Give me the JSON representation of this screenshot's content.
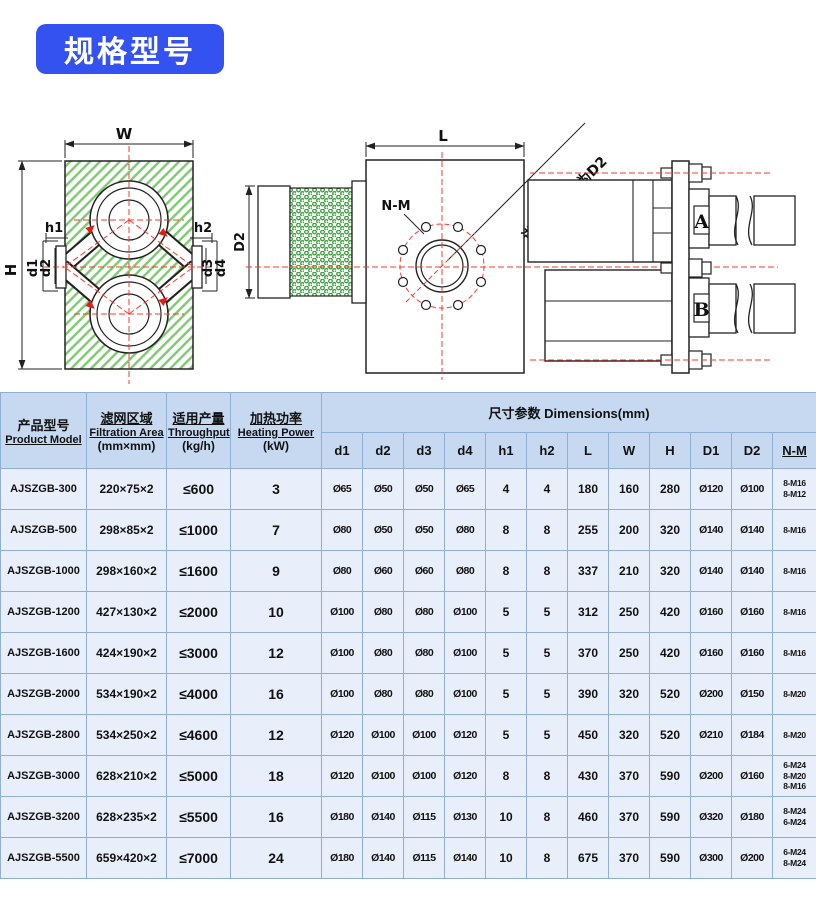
{
  "title_badge": "规格型号",
  "drawings": {
    "front_view": {
      "w": "W",
      "h": "H",
      "h1": "h1",
      "h2": "h2",
      "d1": "d1",
      "d2": "d2",
      "d3": "d3",
      "d4": "d4"
    },
    "side_view": {
      "l": "L",
      "d2": "D2",
      "nm": "N-M",
      "port_note": "进口D1出口为D2"
    },
    "cylinder_view": {
      "a": "A",
      "b": "B"
    }
  },
  "table": {
    "headers": {
      "product_model_zh": "产品型号",
      "product_model_en": "Product Model",
      "filtration_zh": "滤网区域",
      "filtration_en": "Filtration Area",
      "filtration_unit": "(mm×mm)",
      "throughput_zh": "适用产量",
      "throughput_en": "Throughput",
      "throughput_unit": "(kg/h)",
      "heating_zh": "加热功率",
      "heating_en": "Heating Power",
      "heating_unit": "(kW)",
      "dimensions_span": "尺寸参数 Dimensions(mm)",
      "dim_cols": [
        "d1",
        "d2",
        "d3",
        "d4",
        "h1",
        "h2",
        "L",
        "W",
        "H",
        "D1",
        "D2",
        "N-M"
      ]
    },
    "rows": [
      [
        "AJSZGB-300",
        "220×75×2",
        "≤600",
        "3",
        "Ø65",
        "Ø50",
        "Ø50",
        "Ø65",
        "4",
        "4",
        "180",
        "160",
        "280",
        "Ø120",
        "Ø100",
        "8-M16\n8-M12"
      ],
      [
        "AJSZGB-500",
        "298×85×2",
        "≤1000",
        "7",
        "Ø80",
        "Ø50",
        "Ø50",
        "Ø80",
        "8",
        "8",
        "255",
        "200",
        "320",
        "Ø140",
        "Ø140",
        "8-M16"
      ],
      [
        "AJSZGB-1000",
        "298×160×2",
        "≤1600",
        "9",
        "Ø80",
        "Ø60",
        "Ø60",
        "Ø80",
        "8",
        "8",
        "337",
        "210",
        "320",
        "Ø140",
        "Ø140",
        "8-M16"
      ],
      [
        "AJSZGB-1200",
        "427×130×2",
        "≤2000",
        "10",
        "Ø100",
        "Ø80",
        "Ø80",
        "Ø100",
        "5",
        "5",
        "312",
        "250",
        "420",
        "Ø160",
        "Ø160",
        "8-M16"
      ],
      [
        "AJSZGB-1600",
        "424×190×2",
        "≤3000",
        "12",
        "Ø100",
        "Ø80",
        "Ø80",
        "Ø100",
        "5",
        "5",
        "370",
        "250",
        "420",
        "Ø160",
        "Ø160",
        "8-M16"
      ],
      [
        "AJSZGB-2000",
        "534×190×2",
        "≤4000",
        "16",
        "Ø100",
        "Ø80",
        "Ø80",
        "Ø100",
        "5",
        "5",
        "390",
        "320",
        "520",
        "Ø200",
        "Ø150",
        "8-M20"
      ],
      [
        "AJSZGB-2800",
        "534×250×2",
        "≤4600",
        "12",
        "Ø120",
        "Ø100",
        "Ø100",
        "Ø120",
        "5",
        "5",
        "450",
        "320",
        "520",
        "Ø210",
        "Ø184",
        "8-M20"
      ],
      [
        "AJSZGB-3000",
        "628×210×2",
        "≤5000",
        "18",
        "Ø120",
        "Ø100",
        "Ø100",
        "Ø120",
        "8",
        "8",
        "430",
        "370",
        "590",
        "Ø200",
        "Ø160",
        "6-M24\n8-M20\n8-M16"
      ],
      [
        "AJSZGB-3200",
        "628×235×2",
        "≤5500",
        "16",
        "Ø180",
        "Ø140",
        "Ø115",
        "Ø130",
        "10",
        "8",
        "460",
        "370",
        "590",
        "Ø320",
        "Ø180",
        "8-M24\n6-M24"
      ],
      [
        "AJSZGB-5500",
        "659×420×2",
        "≤7000",
        "24",
        "Ø180",
        "Ø140",
        "Ø115",
        "Ø140",
        "10",
        "8",
        "675",
        "370",
        "590",
        "Ø300",
        "Ø200",
        "6-M24\n8-M24"
      ]
    ]
  }
}
